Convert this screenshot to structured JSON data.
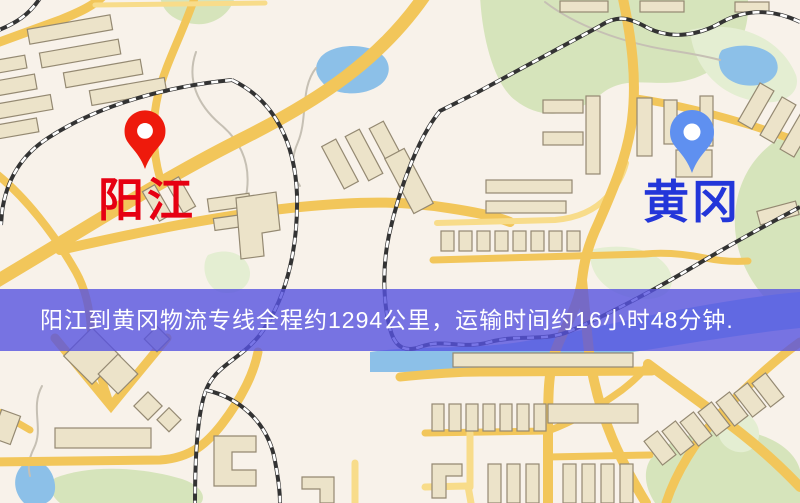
{
  "banner": {
    "text": "阳江到黄冈物流专线全程约1294公里，运输时间约16小时48分钟.",
    "background": "rgba(86,82,224,0.8)",
    "text_color": "#ffffff"
  },
  "map": {
    "origin": {
      "label": "阳江",
      "label_color": "#e60012",
      "pin_color": "#ee1a0c",
      "pin_icon": "red-map-pin"
    },
    "destination": {
      "label": "黄冈",
      "label_color": "#2336d9",
      "pin_color": "#5f90f0",
      "pin_icon": "blue-map-pin"
    },
    "route": {
      "distance_km": "1294",
      "duration": "16小时48分钟"
    }
  },
  "palette": {
    "background": "#f8f2ea",
    "road": "#f2c65a",
    "road_light": "#f8dc8a",
    "building": "#ece3c9",
    "building_stroke": "#948972",
    "park": "#d6e4bb",
    "park_light": "#e4eed2",
    "water": "#8cc0e8",
    "railway": "#333333",
    "stream": "#c6c0b4"
  }
}
